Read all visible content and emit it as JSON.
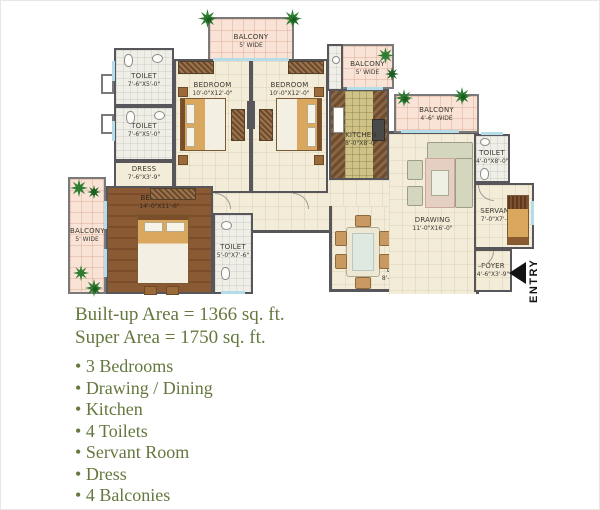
{
  "plan": {
    "entry_label": "ENTRY",
    "rooms": {
      "balcony_top": {
        "name": "BALCONY",
        "dims": "5' WIDE"
      },
      "toilet_tl1": {
        "name": "TOILET",
        "dims": "7'-6\"X5'-0\""
      },
      "toilet_tl2": {
        "name": "TOILET",
        "dims": "7'-6\"X5'-0\""
      },
      "dress": {
        "name": "DRESS",
        "dims": "7'-6\"X3'-9\""
      },
      "bedroom1": {
        "name": "BEDROOM",
        "dims": "10'-0\"X12'-0\""
      },
      "bedroom2": {
        "name": "BEDROOM",
        "dims": "10'-0\"X12'-0\""
      },
      "balcony_tr": {
        "name": "BALCONY",
        "dims": "5' WIDE"
      },
      "kitchen": {
        "name": "KITCHEN",
        "dims": "8'-0\"X8'-0\""
      },
      "balcony_mid": {
        "name": "BALCONY",
        "dims": "4'-6\" WIDE"
      },
      "drawing": {
        "name": "DRAWING",
        "dims": "11'-0\"X16'-0\""
      },
      "dining": {
        "name": "DINING",
        "dims": "8'-6\"X11'-6\""
      },
      "toilet_right": {
        "name": "TOILET",
        "dims": "4'-0\"X8'-0\""
      },
      "servant": {
        "name": "SERVANT",
        "dims": "7'-0\"X7'-0\""
      },
      "foyer": {
        "name": "FOYER",
        "dims": "4'-6\"X3'-9\""
      },
      "master_bedroom": {
        "name": "BEDROOM",
        "dims": "14'-0\"X11'-6\""
      },
      "master_toilet": {
        "name": "TOILET",
        "dims": "5'-0\"X7'-6\""
      },
      "balcony_left": {
        "name": "BALCONY",
        "dims": "5' WIDE"
      }
    }
  },
  "details": {
    "builtup_area": "Built-up Area = 1366 sq. ft.",
    "super_area": "Super Area = 1750 sq. ft.",
    "features": [
      "3 Bedrooms",
      "Drawing / Dining",
      "Kitchen",
      "4 Toilets",
      "Servant Room",
      "Dress",
      "4 Balconies"
    ]
  },
  "colors": {
    "wall": "#57575b",
    "floor": "#f2ecd9",
    "balcony": "#f8e3d6",
    "wood_floor": "#8a5a35",
    "kitchen_tile": "#cfc287",
    "text_green": "#64783e",
    "plant_green": "#2e7d32"
  }
}
